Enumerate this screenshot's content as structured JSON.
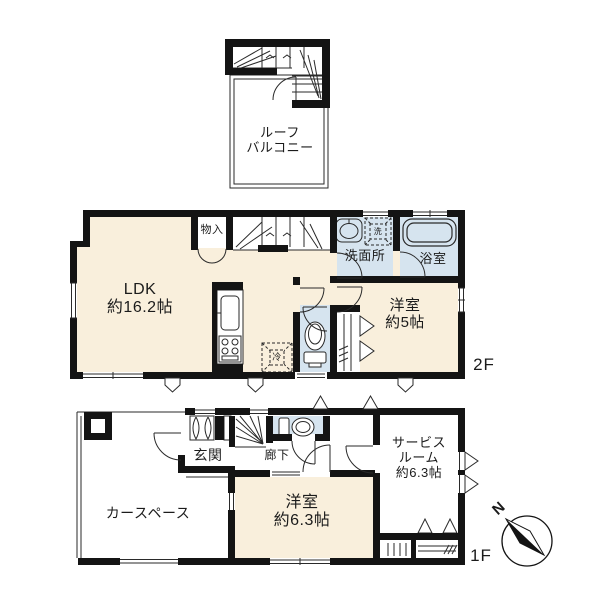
{
  "plan": {
    "type": "floor-plan",
    "labels": {
      "roof_line1": "ルーフ",
      "roof_line2": "バルコニー",
      "storage": "物入",
      "ldk_line1": "LDK",
      "ldk_line2": "約16.2帖",
      "washer": "洗",
      "washroom": "洗面所",
      "bath": "浴室",
      "room5_line1": "洋室",
      "room5_line2": "約5帖",
      "fridge": "冷",
      "floor2": "2F",
      "entrance": "玄関",
      "hallway": "廊下",
      "carspace": "カースペース",
      "room63_line1": "洋室",
      "room63_line2": "約6.3帖",
      "service_line1": "サービス",
      "service_line2": "ルーム",
      "service_line3": "約6.3帖",
      "floor1": "1F",
      "north": "N"
    },
    "colors": {
      "room_cream": "#F9EFDC",
      "room_blue": "#D6E4EF",
      "wall": "#141414",
      "thin_line": "#2a2a2a"
    }
  }
}
